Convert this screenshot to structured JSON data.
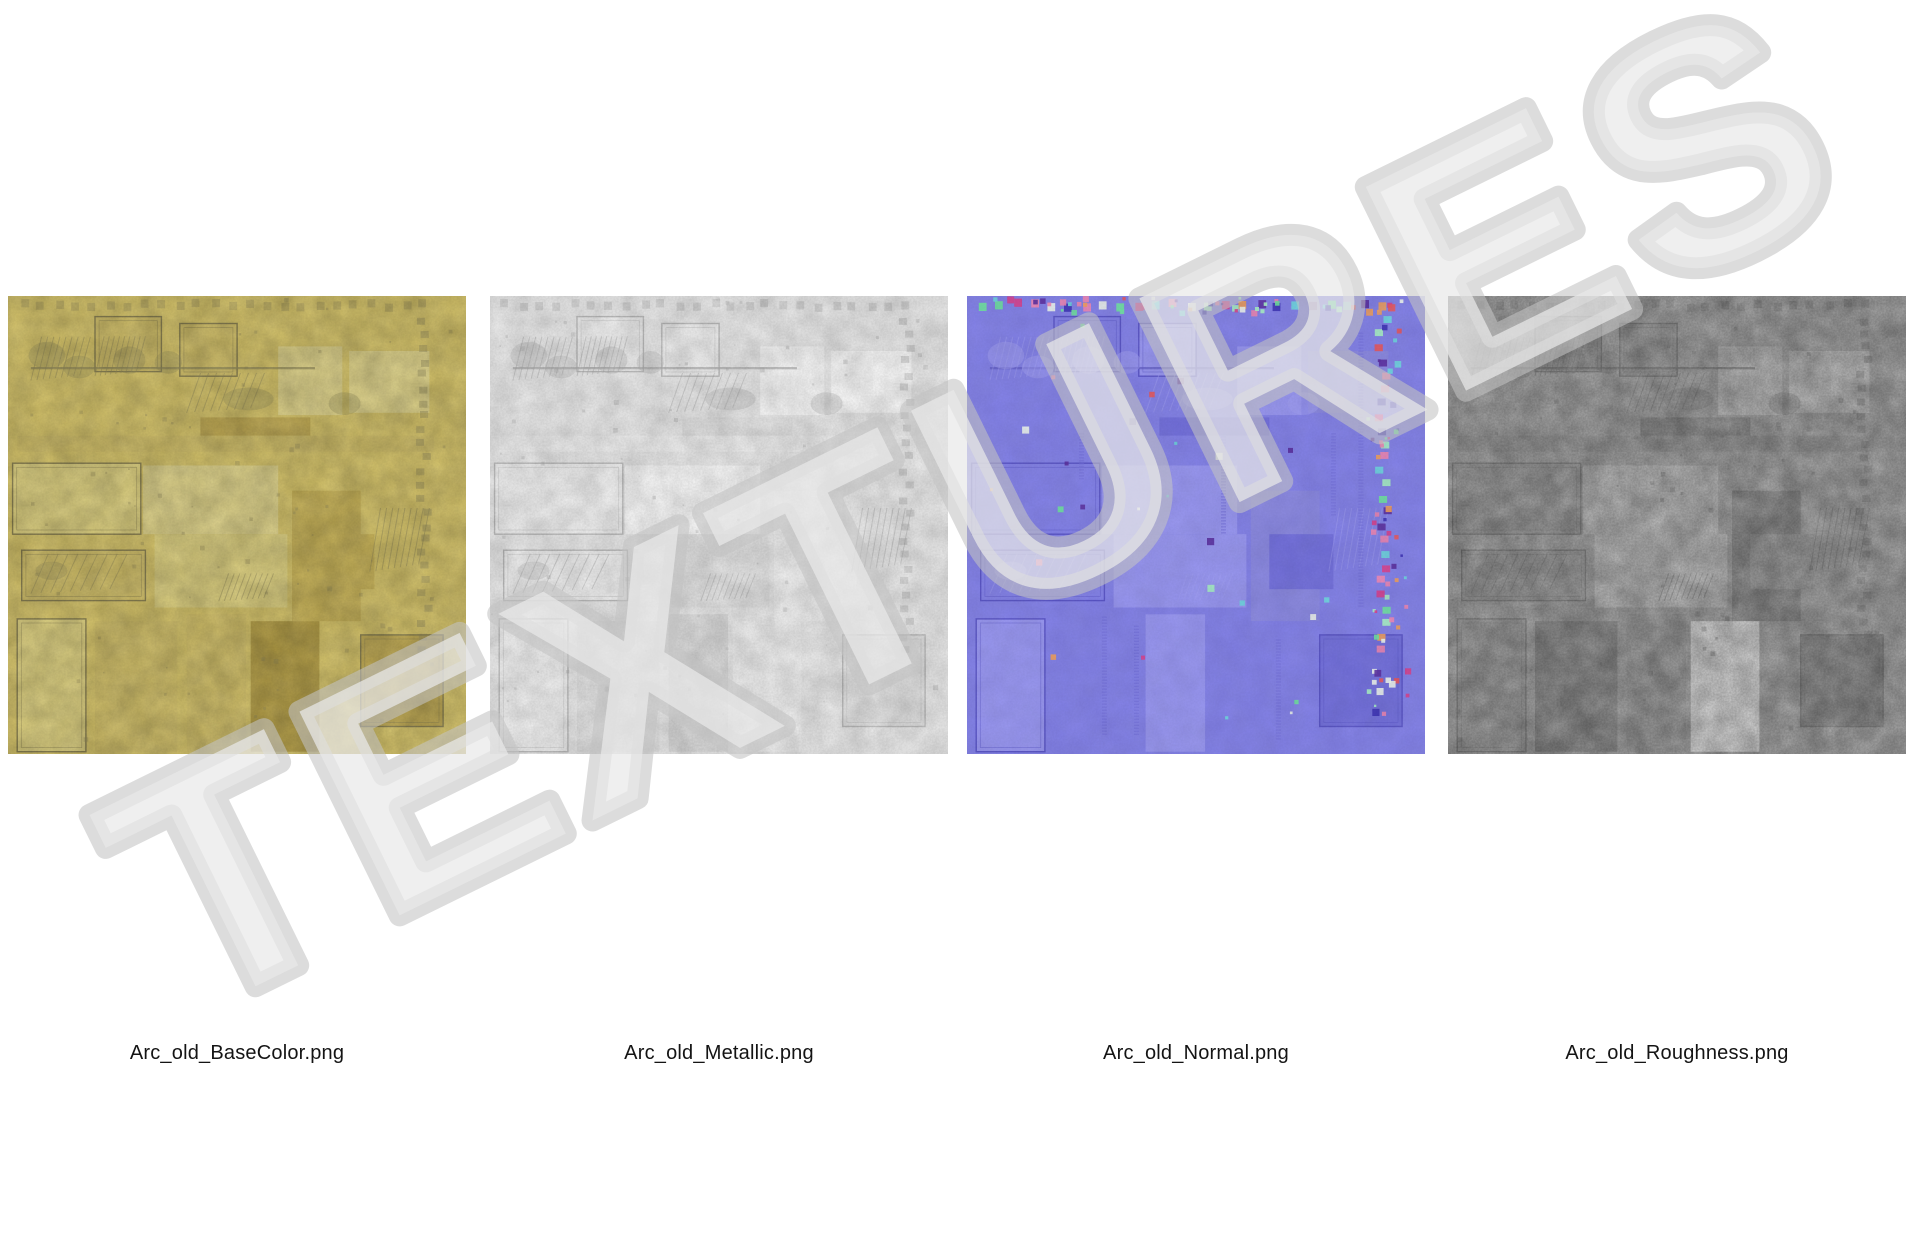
{
  "watermark": {
    "text": "TEXTURES",
    "fill": "#e9e9e9",
    "fill_opacity": 0.72,
    "outline": "#c2c2c2",
    "outline_opacity": 0.58,
    "angle_deg": -26.2
  },
  "files": [
    {
      "label": "Arc_old_BaseColor.png",
      "map": "basecolor"
    },
    {
      "label": "Arc_old_Metallic.png",
      "map": "metallic"
    },
    {
      "label": "Arc_old_Normal.png",
      "map": "normal"
    },
    {
      "label": "Arc_old_Roughness.png",
      "map": "roughness"
    }
  ],
  "palettes": {
    "basecolor": {
      "bg": "#d6c469",
      "light": "#ddd07f",
      "panel": "#e0d48a",
      "mid": "#d1bf68",
      "dark": "#bfa952",
      "dark2": "#c7b257",
      "darker": "#b49e46",
      "bright": "#e3d892",
      "detail": "#8f8757",
      "frame": "#877e4e",
      "mottle_dark": 0.22,
      "mottle_light": 0.08,
      "grain": 0.08,
      "dots": 0.35,
      "speckles": false,
      "zips": false
    },
    "metallic": {
      "bg": "#efefef",
      "light": "#f6f6f6",
      "panel": "#fafafa",
      "mid": "#e7e7e7",
      "dark": "#dedede",
      "dark2": "#e3e3e3",
      "darker": "#d6d6d6",
      "bright": "#ffffff",
      "detail": "#a9a9a9",
      "frame": "#bdbdbd",
      "mottle_dark": 0.16,
      "mottle_light": 0.25,
      "grain": 0.1,
      "dots": 0.35,
      "speckles": false,
      "zips": false
    },
    "normal": {
      "bg": "#8381e9",
      "light": "#8f8def",
      "panel": "#9795f1",
      "mid": "#7c7ae4",
      "dark": "#7370dd",
      "dark2": "#8a88e2",
      "darker": "#6966d6",
      "bright": "#a2a0f4",
      "detail": "#5f5bc4",
      "frame": "#5a55c8",
      "mottle_dark": 0.07,
      "mottle_light": 0.05,
      "grain": 0.05,
      "dots": 0,
      "speckles": true,
      "zips": true
    },
    "roughness": {
      "bg": "#9f9f9f",
      "light": "#b6b6b6",
      "panel": "#c0c0c0",
      "mid": "#969696",
      "dark": "#868686",
      "dark2": "#8e8e8e",
      "darker": "#7c7c7c",
      "bright": "#d9d9d9",
      "detail": "#6e6e6e",
      "frame": "#787878",
      "mottle_dark": 0.28,
      "mottle_light": 0.3,
      "grain": 0.22,
      "dots": 0.4,
      "speckles": false,
      "zips": false
    }
  },
  "speckle_colors": [
    "#6fe3a1",
    "#a8f2c6",
    "#ef86b5",
    "#d8408f",
    "#e8565e",
    "#f2a05e",
    "#6fd8e2",
    "#3d32b8",
    "#5b2fa2",
    "#eef6f0"
  ],
  "atlas": {
    "rects": [
      {
        "x": 19,
        "y": 4.5,
        "w": 14.5,
        "h": 12,
        "frame": true,
        "t": {
          "b": "mid",
          "m": "light",
          "n": "base",
          "r": "mid"
        }
      },
      {
        "x": 37.5,
        "y": 6,
        "w": 12.5,
        "h": 11.5,
        "frame": true,
        "t": {
          "b": "mid",
          "m": "light",
          "n": "panel",
          "r": "mid"
        }
      },
      {
        "x": 59,
        "y": 11,
        "w": 14,
        "h": 15,
        "frame": false,
        "t": {
          "b": "panel",
          "m": "bright",
          "n": "panel",
          "r": "light"
        }
      },
      {
        "x": 74.5,
        "y": 12,
        "w": 17.5,
        "h": 13.5,
        "frame": false,
        "t": {
          "b": "panel",
          "m": "bright",
          "n": "dark2",
          "r": "light"
        }
      },
      {
        "x": 42,
        "y": 26.5,
        "w": 24,
        "h": 4,
        "frame": false,
        "t": {
          "b": "dark",
          "m": "mid",
          "n": "dark",
          "r": "dark"
        }
      },
      {
        "x": 2,
        "y": 30.5,
        "w": 91,
        "h": 3.5,
        "frame": false,
        "t": {
          "b": "mid",
          "m": "light",
          "n": "base",
          "r": "mid"
        }
      },
      {
        "x": 1,
        "y": 36.5,
        "w": 28,
        "h": 15.5,
        "frame": true,
        "t": {
          "b": "light",
          "m": "light",
          "n": "base",
          "r": "mid"
        }
      },
      {
        "x": 29.5,
        "y": 37,
        "w": 29.5,
        "h": 15,
        "frame": false,
        "t": {
          "b": "panel",
          "m": "bright",
          "n": "panel",
          "r": "light"
        }
      },
      {
        "x": 32,
        "y": 52,
        "w": 29,
        "h": 16,
        "frame": false,
        "t": {
          "b": "light",
          "m": "mid",
          "n": "panel",
          "r": "light"
        }
      },
      {
        "x": 62,
        "y": 42.5,
        "w": 15,
        "h": 28.5,
        "frame": false,
        "t": {
          "b": "dark2",
          "m": "light",
          "n": "dark2",
          "r": "dark"
        }
      },
      {
        "x": 66,
        "y": 52,
        "w": 14,
        "h": 12,
        "frame": false,
        "t": {
          "b": "dark2",
          "m": "light",
          "n": "dark",
          "r": "mid"
        }
      },
      {
        "x": 3,
        "y": 55.5,
        "w": 27,
        "h": 11,
        "frame": true,
        "t": {
          "b": "mid",
          "m": "light",
          "n": "base",
          "r": "mid"
        }
      },
      {
        "x": 2,
        "y": 70.5,
        "w": 15,
        "h": 29,
        "frame": true,
        "t": {
          "b": "light",
          "m": "light",
          "n": "panel",
          "r": "mid"
        }
      },
      {
        "x": 19,
        "y": 71,
        "w": 18,
        "h": 28.5,
        "frame": false,
        "t": {
          "b": "mid",
          "m": "mid",
          "n": "base",
          "r": "dark"
        }
      },
      {
        "x": 39,
        "y": 69.5,
        "w": 13,
        "h": 30,
        "frame": false,
        "t": {
          "b": "mid",
          "m": "dark",
          "n": "panel",
          "r": "mid"
        }
      },
      {
        "x": 53,
        "y": 71,
        "w": 15,
        "h": 28.5,
        "frame": false,
        "t": {
          "b": "darker",
          "m": "light",
          "n": "base",
          "r": "bright"
        }
      },
      {
        "x": 77,
        "y": 74,
        "w": 18,
        "h": 20,
        "frame": true,
        "t": {
          "b": "dark",
          "m": "mid",
          "n": "dark",
          "r": "dark"
        }
      }
    ],
    "lines": [
      {
        "x": 5,
        "y": 15.5,
        "w": 62,
        "h": 0.5
      }
    ],
    "fans": [
      {
        "x": 5,
        "y": 8,
        "w": 13,
        "h": 11
      },
      {
        "x": 19,
        "y": 8,
        "w": 11,
        "h": 10
      },
      {
        "x": 39,
        "y": 16,
        "w": 17,
        "h": 10
      },
      {
        "x": 5,
        "y": 55.5,
        "w": 21,
        "h": 10
      },
      {
        "x": 79,
        "y": 45,
        "w": 13,
        "h": 16
      },
      {
        "x": 46,
        "y": 60,
        "w": 12,
        "h": 7
      }
    ],
    "blobs": [
      {
        "x": 4.5,
        "y": 10,
        "w": 8,
        "h": 6
      },
      {
        "x": 12,
        "y": 13,
        "w": 7,
        "h": 5
      },
      {
        "x": 23,
        "y": 11,
        "w": 7,
        "h": 6
      },
      {
        "x": 32,
        "y": 12,
        "w": 6,
        "h": 5
      },
      {
        "x": 47,
        "y": 20,
        "w": 11,
        "h": 5
      },
      {
        "x": 6,
        "y": 58,
        "w": 7,
        "h": 4
      },
      {
        "x": 70,
        "y": 21,
        "w": 7,
        "h": 5
      }
    ],
    "zips": [
      {
        "x": 30,
        "y": 70,
        "h": 26
      },
      {
        "x": 37,
        "y": 72,
        "h": 24
      },
      {
        "x": 25,
        "y": 30,
        "h": 10
      },
      {
        "x": 56,
        "y": 30,
        "h": 22
      },
      {
        "x": 68,
        "y": 75,
        "h": 22
      },
      {
        "x": 80,
        "y": 30,
        "h": 18
      },
      {
        "x": 86,
        "y": 8,
        "h": 60
      }
    ]
  }
}
